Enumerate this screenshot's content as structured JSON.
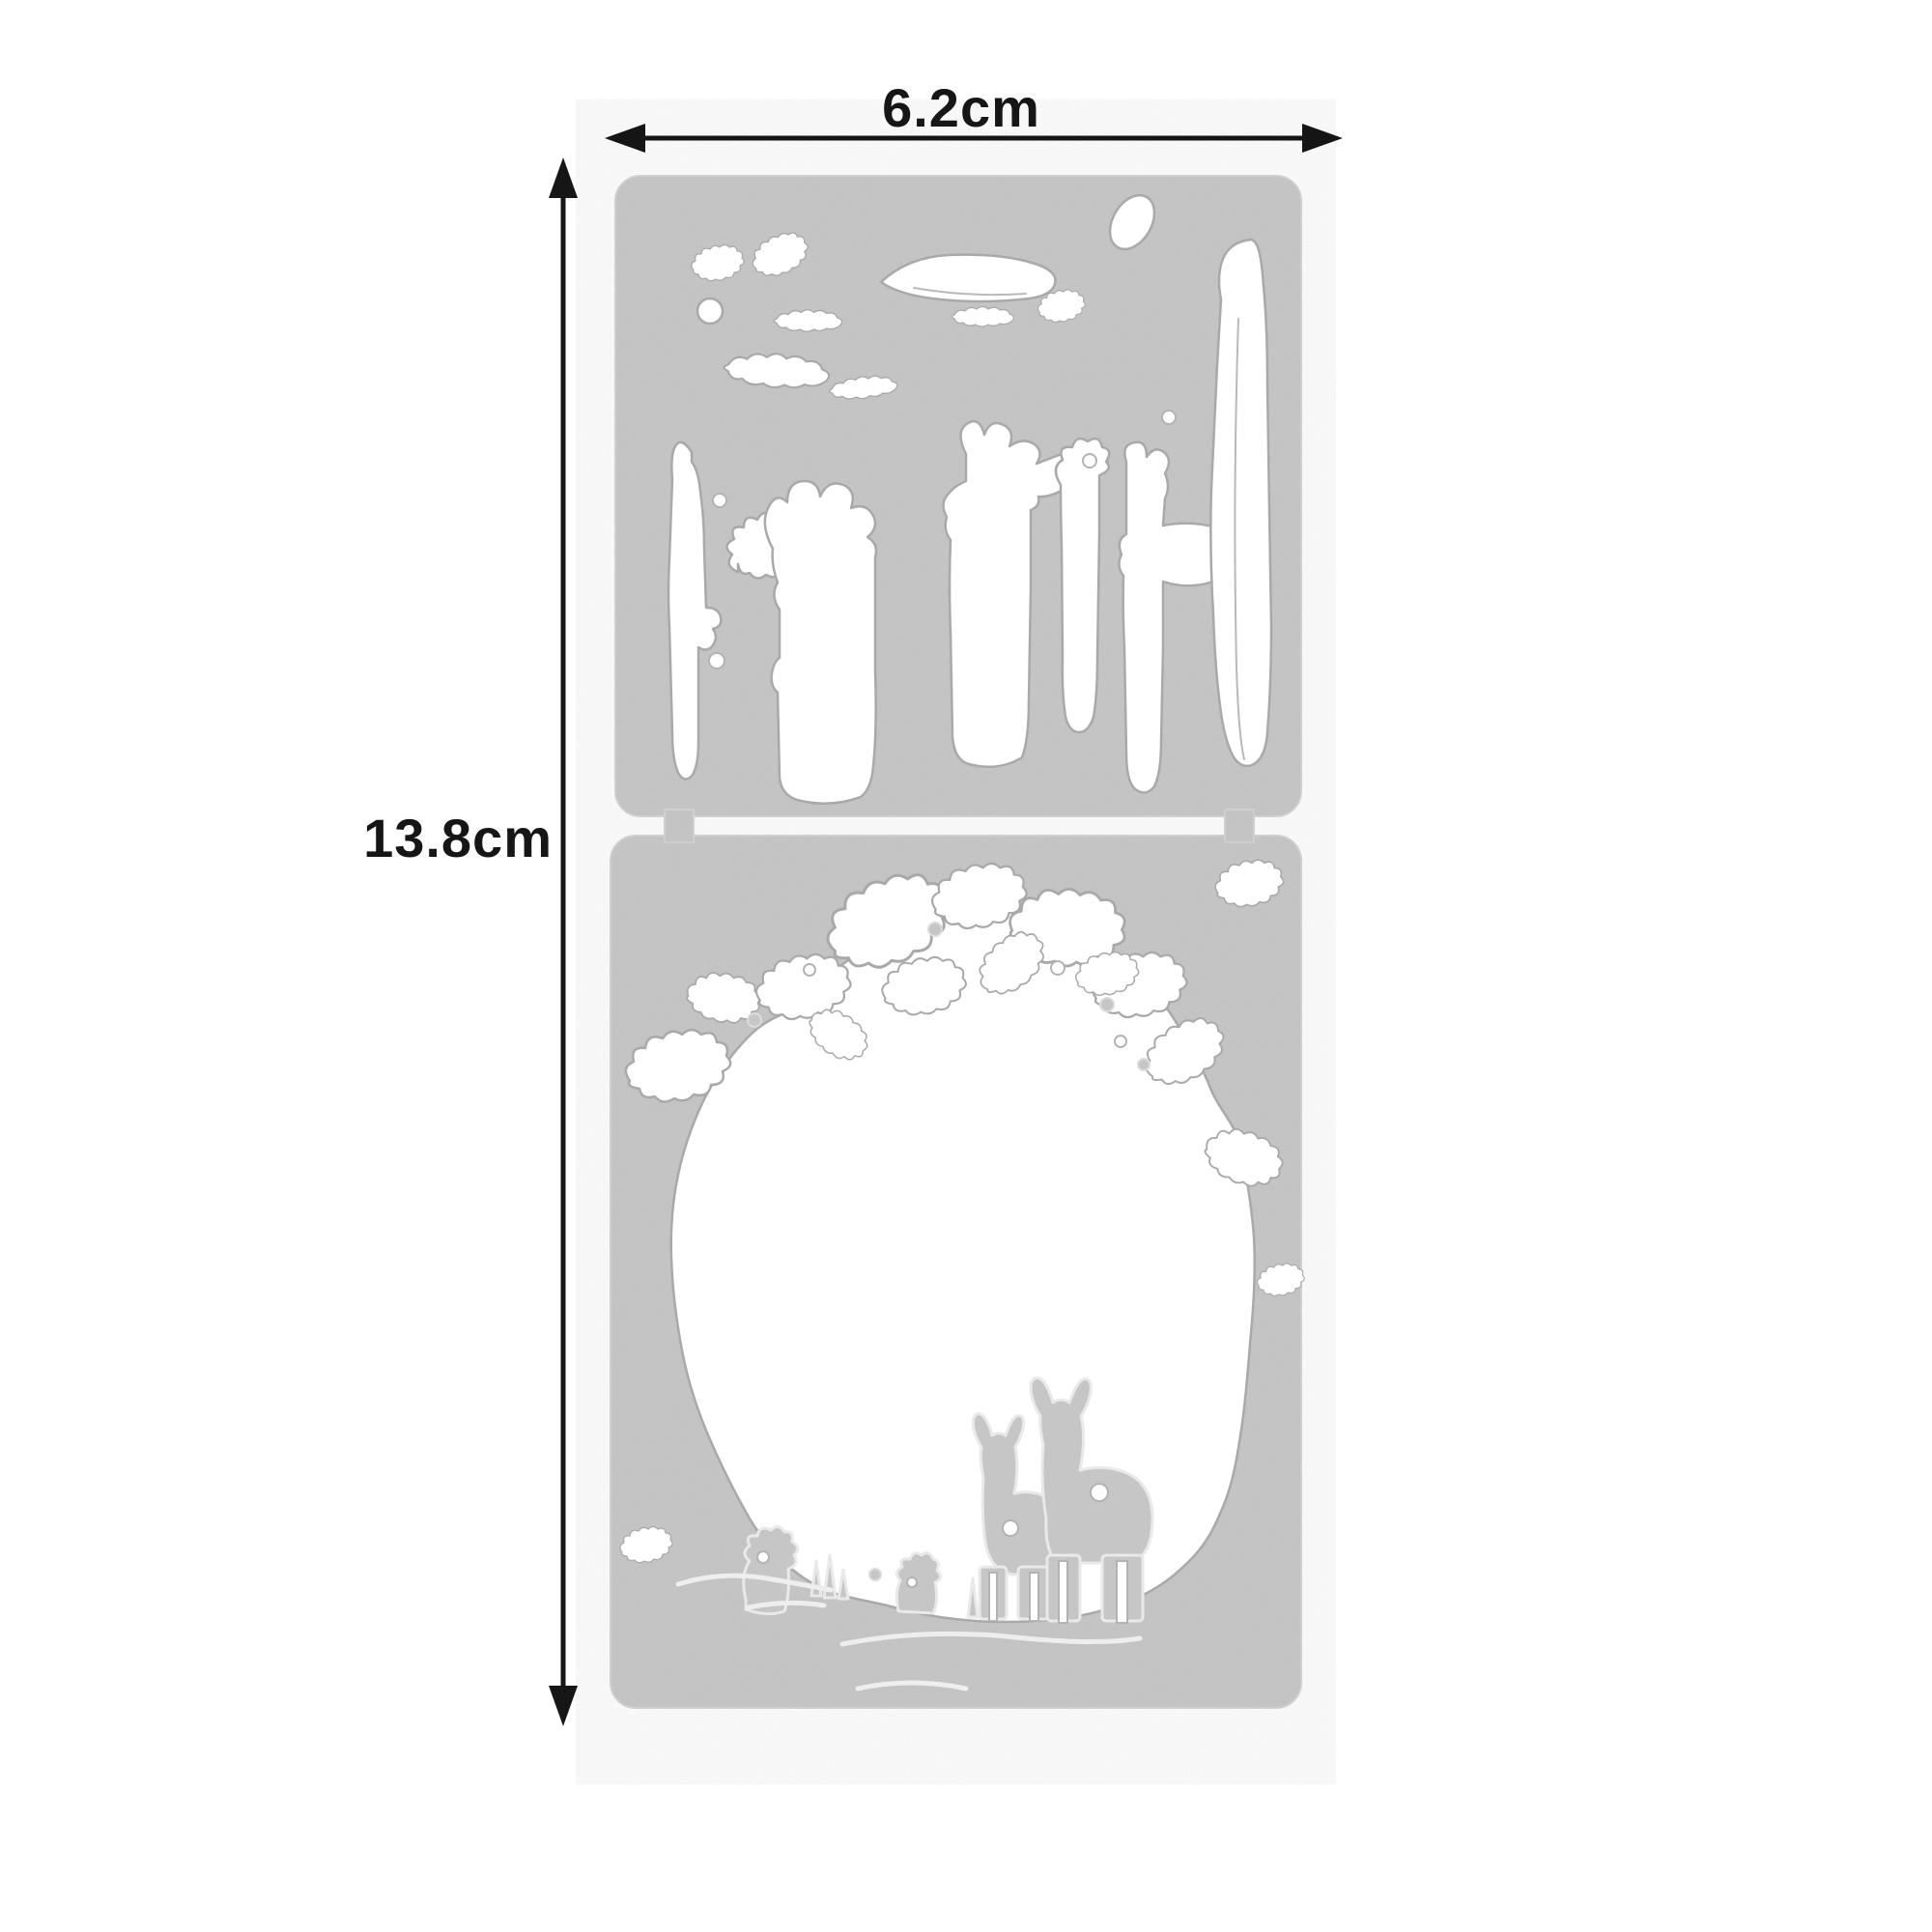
{
  "page": {
    "background_color": "#ffffff"
  },
  "annotations": {
    "width_label": "6.2cm",
    "height_label": "13.8cm",
    "line_color": "#161616",
    "icons": {
      "width_arrow": "double-headed-horizontal-arrow",
      "height_arrow": "double-headed-vertical-arrow"
    }
  },
  "product": {
    "description": "Two-piece metal cutting die set",
    "plate_color": "#c6c6c6",
    "cutout_color": "#ffffff",
    "cut_edge_color": "#a9a9a9",
    "plates": [
      {
        "label": "top die: forest tree trunks and foliage cutouts"
      },
      {
        "label": "bottom die: forest clearing with foliage and two giraffes"
      }
    ]
  }
}
